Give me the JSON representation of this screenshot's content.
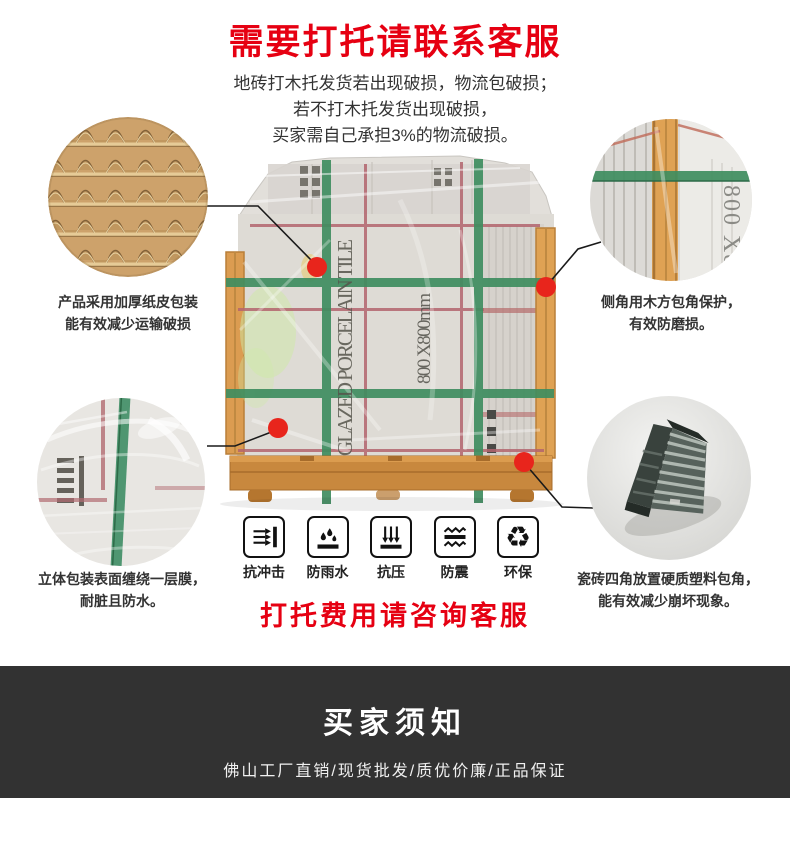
{
  "header": {
    "title": "需要打托请联系客服",
    "lines": [
      "地砖打木托发货若出现破损，物流包破损；",
      "若不打木托发货出现破损，",
      "买家需自己承担3%的物流破损。"
    ]
  },
  "callouts": {
    "top_left": {
      "image": "corrugated-cardboard-closeup",
      "lines": [
        "产品采用加厚纸皮包装",
        "能有效减少运输破损"
      ]
    },
    "top_right": {
      "image": "wood-corner-protection-closeup",
      "lines": [
        "侧角用木方包角保护，",
        "有效防磨损。"
      ],
      "box_text": "800 X8"
    },
    "bottom_left": {
      "image": "stretch-film-wrap-closeup",
      "lines": [
        "立体包装表面缠绕一层膜，",
        "耐脏且防水。"
      ]
    },
    "bottom_right": {
      "image": "plastic-corner-protector-closeup",
      "lines": [
        "瓷砖四角放置硬质塑料包角，",
        "能有效减少崩坏现象。"
      ]
    }
  },
  "package": {
    "side_text": "GLAZED PORCELAIN TILE",
    "size_text": "800 X800mm"
  },
  "features": [
    {
      "icon": "impact-resistant-icon",
      "label": "抗冲击"
    },
    {
      "icon": "rainproof-icon",
      "label": "防雨水"
    },
    {
      "icon": "pressure-resistant-icon",
      "label": "抗压"
    },
    {
      "icon": "shockproof-icon",
      "label": "防震"
    },
    {
      "icon": "eco-friendly-icon",
      "label": "环保",
      "glyph": "♻"
    }
  ],
  "notice": {
    "text": "打托费用请咨询客服"
  },
  "footer": {
    "title": "买家须知",
    "subtitle": "佛山工厂直销/现货批发/质优价廉/正品保证"
  },
  "colors": {
    "accent_red": "#e60012",
    "callout_dot_red": "#e8251c",
    "strap_green": "#3f8d60",
    "strap_red": "#b3656e",
    "wood": "#dfa254",
    "pallet_wood": "#c8883e",
    "footer_bg": "#323232",
    "text_dark": "#333333"
  }
}
